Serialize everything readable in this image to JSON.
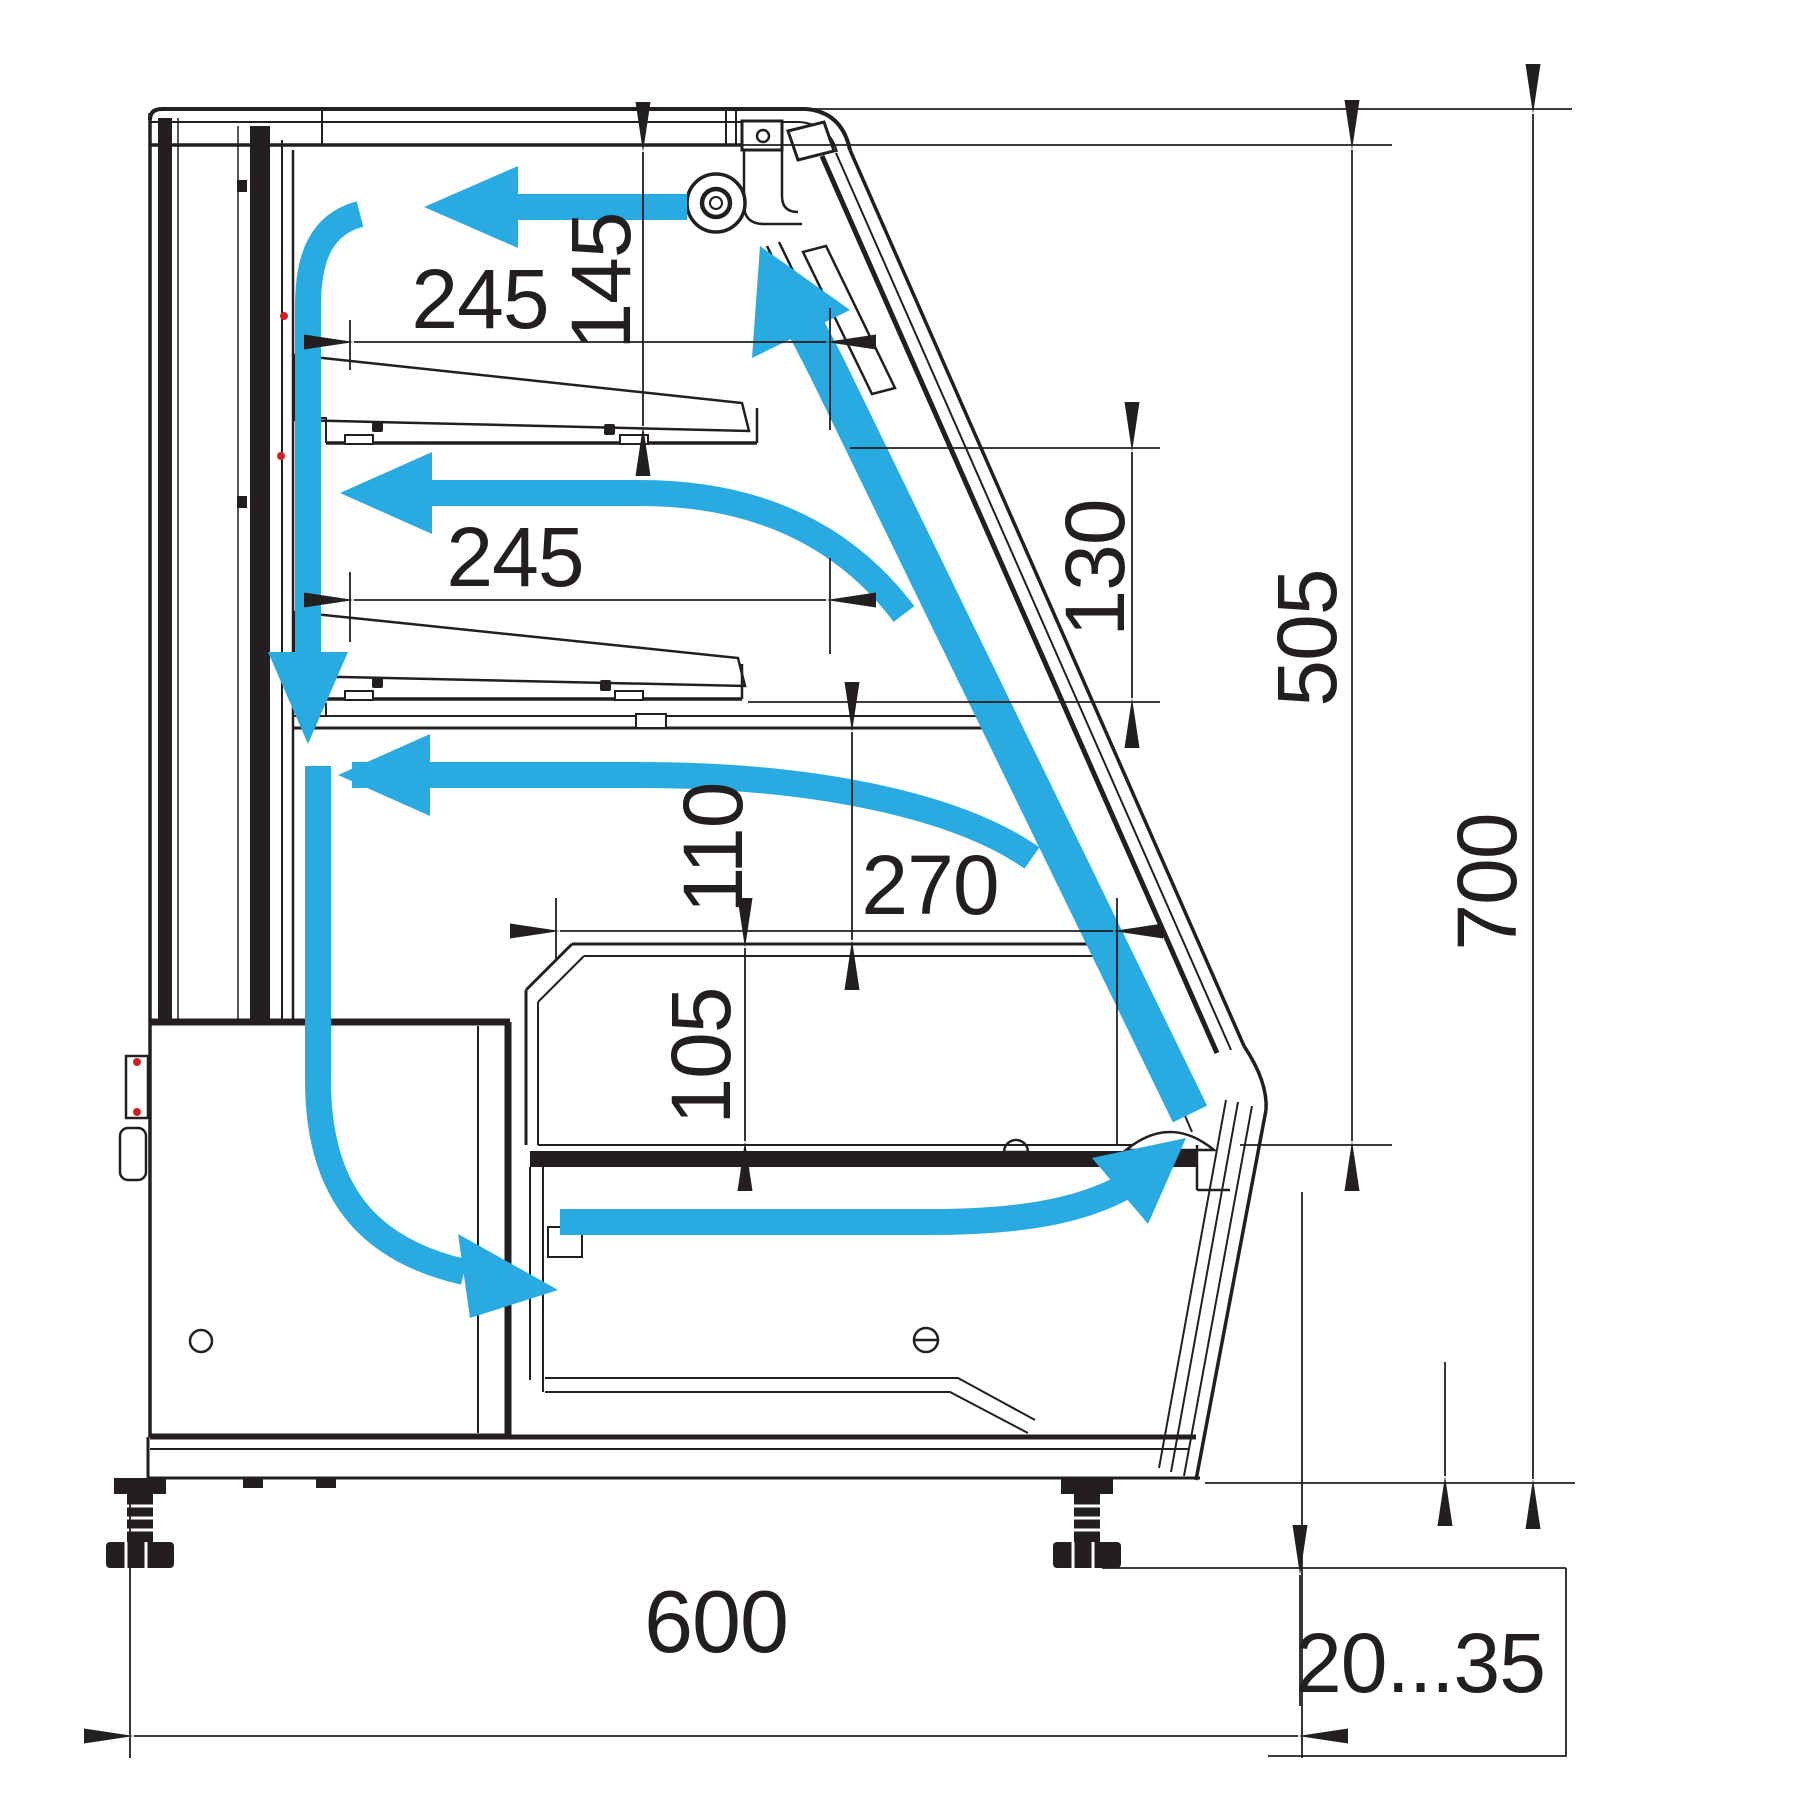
{
  "title": "refrigerated-display-case-cross-section-airflow-diagram",
  "colors": {
    "line": "#231F20",
    "airflow": "#29ABE2",
    "background": "#FFFFFF",
    "marker_red": "#CC2229"
  },
  "dimensions": {
    "shelf_top_width": "245",
    "canopy_to_shelf": "145",
    "shelf_middle_width": "245",
    "glass_gap": "130",
    "inner_height": "505",
    "overall_height": "700",
    "duct_to_well": "110",
    "well_width": "270",
    "well_depth": "105",
    "overall_depth": "600",
    "floor_clearance": "20...35"
  },
  "icons": {
    "fan": "evaporator-fan",
    "airflow_arrows": "air-circulation-path"
  }
}
